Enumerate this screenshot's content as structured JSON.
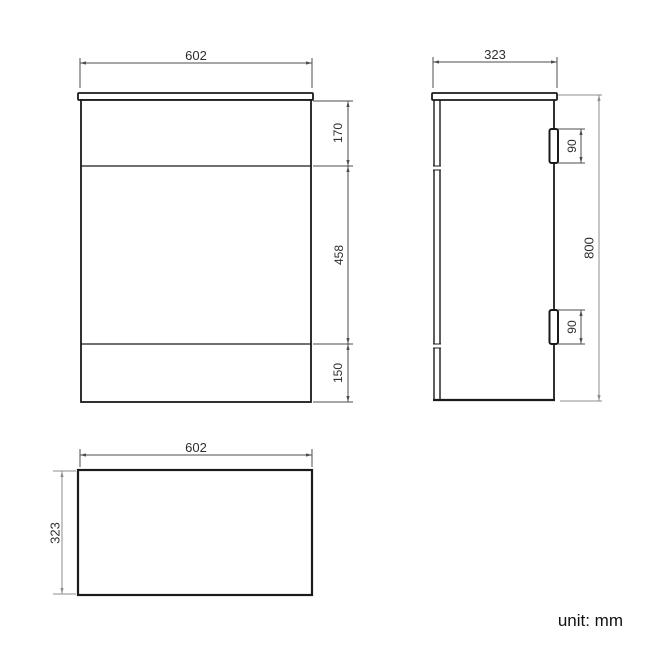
{
  "drawing": {
    "units_note": "unit: mm",
    "dimensions_mm": {
      "width": 602,
      "depth": 323,
      "height": 800,
      "top_section_height": 170,
      "middle_section_height": 458,
      "bottom_section_height": 150,
      "hinge_length": 90
    },
    "front_view": {
      "width_label": "602",
      "top_section_label": "170",
      "middle_section_label": "458",
      "bottom_section_label": "150"
    },
    "side_view": {
      "depth_label": "323",
      "height_label": "800",
      "hinge_top_label": "90",
      "hinge_bottom_label": "90"
    },
    "top_view": {
      "width_label": "602",
      "depth_label": "323"
    },
    "colors": {
      "object_line": "#1a1a1a",
      "dimension_line": "#4d4d4d",
      "dimension_line_light": "#8c8c8c",
      "text": "#2e2e2e",
      "background": "#ffffff"
    }
  }
}
